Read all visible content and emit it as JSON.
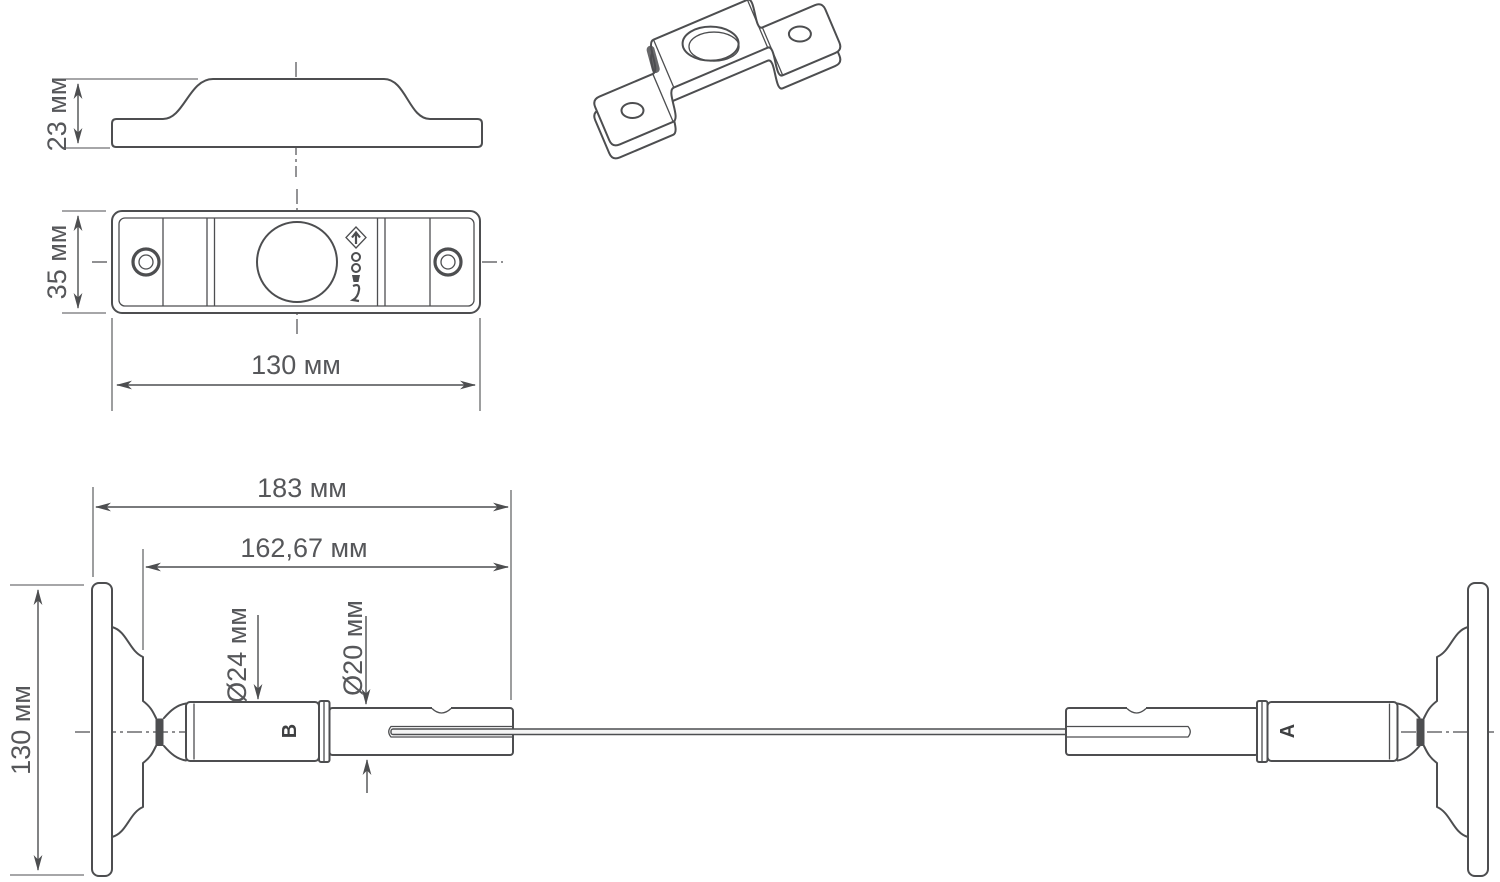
{
  "colors": {
    "background": "#ffffff",
    "line": "#4d4e50",
    "text": "#56575a"
  },
  "views": {
    "side_view": {
      "height_dim": "23 мм"
    },
    "plan_view": {
      "width_dim": "35 мм",
      "length_dim": "130 мм"
    },
    "assembly_view": {
      "overall_length_dim": "183 мм",
      "rod_length_dim": "162,67 мм",
      "large_diameter_dim": "Ø24 мм",
      "small_diameter_dim": "Ø20 мм",
      "height_dim": "130 мм",
      "left_joint_label": "В",
      "right_joint_label": "А"
    }
  }
}
